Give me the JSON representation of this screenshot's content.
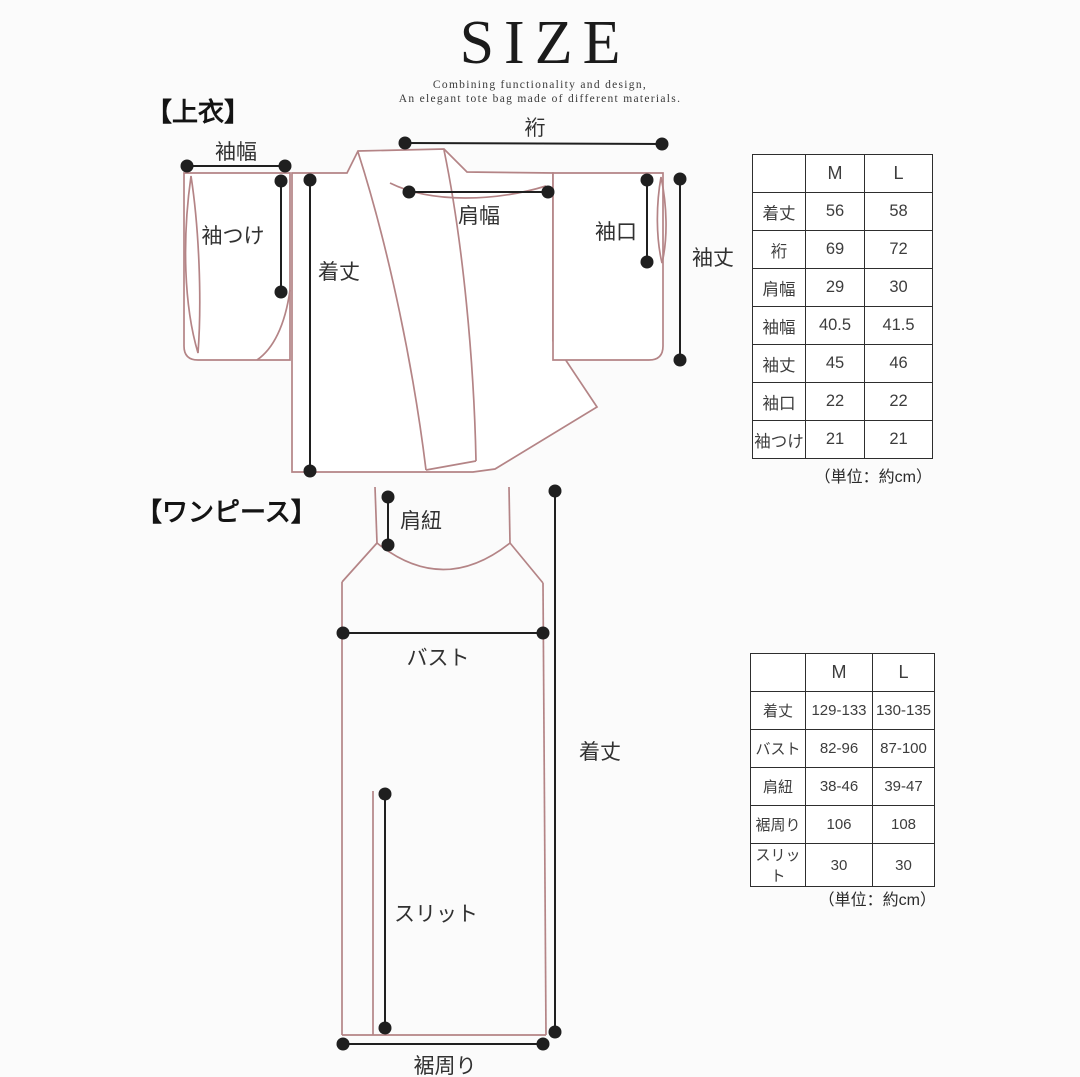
{
  "colors": {
    "paper": "#fbfbfb",
    "ink": "#1b1b1b",
    "garment": "#b48486",
    "measure": "#1f1f1f",
    "tableBorder": "#2e2e2e",
    "tableText": "#3d3d3d"
  },
  "header": {
    "title": "SIZE",
    "subtitle_line1": "Combining functionality and design,",
    "subtitle_line2": "An elegant tote bag made of different materials."
  },
  "sections": {
    "top_label": "【上衣】",
    "dress_label": "【ワンピース】"
  },
  "diagram_labels": {
    "top": {
      "sleeve_width": "袖幅",
      "sleeve_attach": "袖つけ",
      "length": "着丈",
      "yuki": "裄",
      "shoulder_width": "肩幅",
      "cuff": "袖口",
      "sleeve_length": "袖丈"
    },
    "dress": {
      "strap": "肩紐",
      "bust": "バスト",
      "length": "着丈",
      "slit": "スリット",
      "hem": "裾周り"
    }
  },
  "tables": [
    {
      "columns": [
        "M",
        "L"
      ],
      "rows": [
        {
          "label": "着丈",
          "m": "56",
          "l": "58"
        },
        {
          "label": "裄",
          "m": "69",
          "l": "72"
        },
        {
          "label": "肩幅",
          "m": "29",
          "l": "30"
        },
        {
          "label": "袖幅",
          "m": "40.5",
          "l": "41.5"
        },
        {
          "label": "袖丈",
          "m": "45",
          "l": "46"
        },
        {
          "label": "袖口",
          "m": "22",
          "l": "22"
        },
        {
          "label": "袖つけ",
          "m": "21",
          "l": "21"
        }
      ],
      "unit_note": "（単位：約cm）"
    },
    {
      "columns": [
        "M",
        "L"
      ],
      "rows": [
        {
          "label": "着丈",
          "m": "129-133",
          "l": "130-135"
        },
        {
          "label": "バスト",
          "m": "82-96",
          "l": "87-100"
        },
        {
          "label": "肩紐",
          "m": "38-46",
          "l": "39-47"
        },
        {
          "label": "裾周り",
          "m": "106",
          "l": "108"
        },
        {
          "label": "スリット",
          "m": "30",
          "l": "30"
        }
      ],
      "unit_note": "（単位：約cm）"
    }
  ]
}
